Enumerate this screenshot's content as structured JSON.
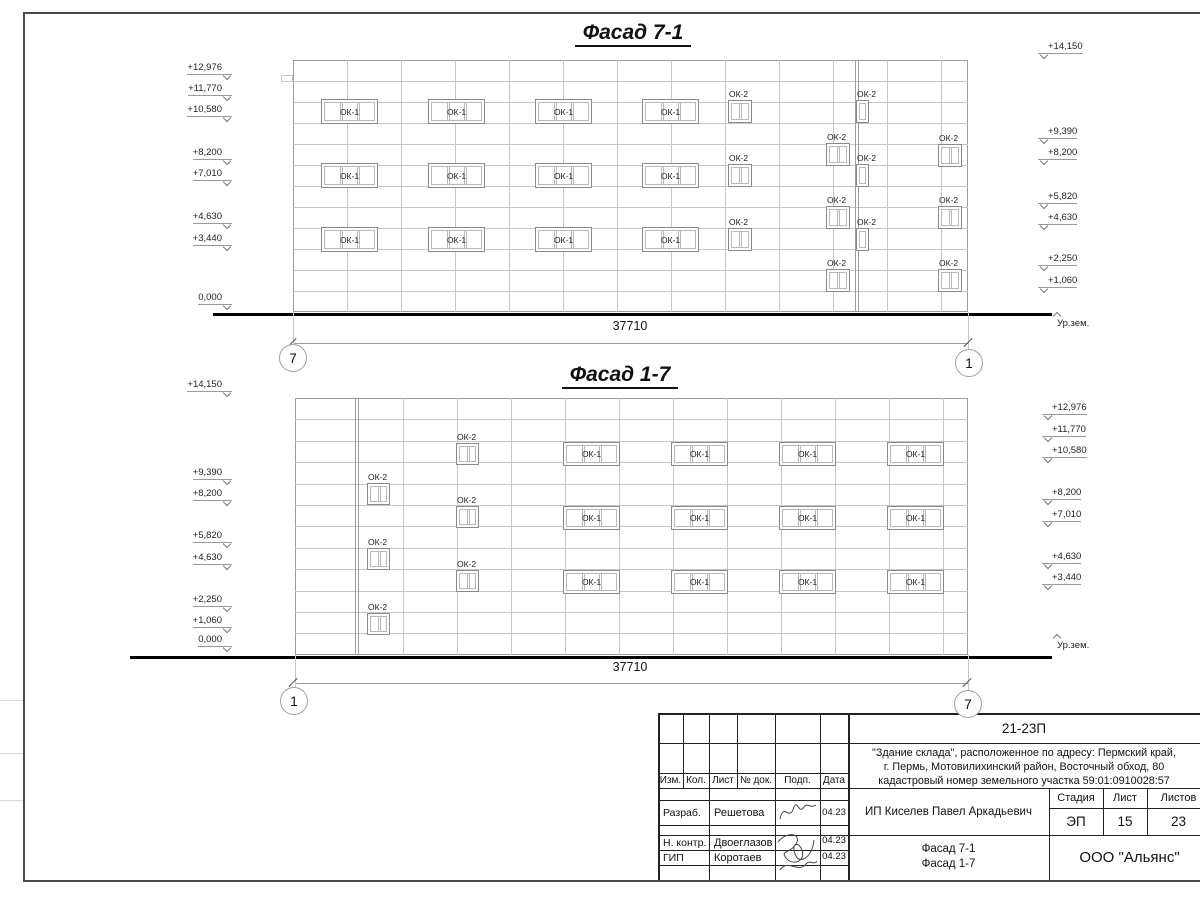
{
  "facades": [
    {
      "title": "Фасад 7-1",
      "box": {
        "x": 293,
        "y": 60,
        "w": 675,
        "h": 252,
        "hlines": 11,
        "hstep": 21,
        "vstep": 54
      },
      "heavy_verticals": [
        855
      ],
      "ledge": {
        "x": 281,
        "y": 75,
        "w": 12,
        "h": 7
      },
      "windows_ok1": {
        "w": 57,
        "h": 25,
        "panes": 3,
        "label": "ОК-1",
        "cols": [
          321,
          428,
          535,
          642
        ],
        "rows": [
          99,
          163,
          227
        ]
      },
      "windows_ok2": {
        "w": 24,
        "h": 23,
        "panes": 2,
        "label": "ОК-2",
        "items": [
          [
            728,
            100
          ],
          [
            728,
            164
          ],
          [
            728,
            228
          ],
          [
            826,
            143
          ],
          [
            826,
            206
          ],
          [
            826,
            269
          ],
          [
            938,
            144
          ],
          [
            938,
            206
          ],
          [
            938,
            269
          ]
        ]
      },
      "windows_ok2_narrow": {
        "w": 13,
        "h": 23,
        "panes": 1,
        "label": "ОК-2",
        "items": [
          [
            856,
            100
          ],
          [
            856,
            164
          ],
          [
            856,
            228
          ]
        ]
      },
      "marks_left": [
        [
          "+12,976",
          68
        ],
        [
          "+11,770",
          89
        ],
        [
          "+10,580",
          110
        ],
        [
          "+8,200",
          153
        ],
        [
          "+7,010",
          174
        ],
        [
          "+4,630",
          217
        ],
        [
          "+3,440",
          239
        ],
        [
          "0,000",
          298
        ]
      ],
      "marks_right": [
        [
          "+14,150",
          47
        ],
        [
          "+9,390",
          132
        ],
        [
          "+8,200",
          153
        ],
        [
          "+5,820",
          197
        ],
        [
          "+4,630",
          218
        ],
        [
          "+2,250",
          259
        ],
        [
          "+1,060",
          281
        ]
      ],
      "marks_left_x": 140,
      "marks_right_x": 1038,
      "ground": {
        "y": 313,
        "x1": 213,
        "x2": 1052,
        "label": "Ур.зем.",
        "lx": 1057,
        "ly": 318
      },
      "dim": {
        "text": "37710",
        "y": 343,
        "tx": 630,
        "ty": 319
      },
      "bubbles": [
        {
          "t": "7",
          "cx": 292,
          "cy": 357
        },
        {
          "t": "1",
          "cx": 968,
          "cy": 362
        }
      ],
      "title_cx": 633,
      "title_cy": 36
    },
    {
      "title": "Фасад 1-7",
      "box": {
        "x": 295,
        "y": 398,
        "w": 673,
        "h": 257,
        "hlines": 11,
        "hstep": 21.4,
        "vstep": 54
      },
      "heavy_verticals": [
        355
      ],
      "ledge": null,
      "windows_ok1": {
        "w": 57,
        "h": 24,
        "panes": 3,
        "label": "ОК-1",
        "cols": [
          563,
          671,
          779,
          887
        ],
        "rows": [
          442,
          506,
          570
        ]
      },
      "windows_ok2": {
        "w": 23,
        "h": 22,
        "panes": 2,
        "label": "ОК-2",
        "items": [
          [
            367,
            483
          ],
          [
            367,
            548
          ],
          [
            367,
            613
          ],
          [
            456,
            443
          ],
          [
            456,
            506
          ],
          [
            456,
            570
          ]
        ]
      },
      "windows_ok2_narrow": {
        "w": 13,
        "h": 22,
        "panes": 1,
        "label": "ОК-2",
        "items": []
      },
      "marks_left": [
        [
          "+14,150",
          385
        ],
        [
          "+9,390",
          473
        ],
        [
          "+8,200",
          494
        ],
        [
          "+5,820",
          536
        ],
        [
          "+4,630",
          558
        ],
        [
          "+2,250",
          600
        ],
        [
          "+1,060",
          621
        ],
        [
          "0,000",
          640
        ]
      ],
      "marks_right": [
        [
          "+12,976",
          408
        ],
        [
          "+11,770",
          430
        ],
        [
          "+10,580",
          451
        ],
        [
          "+8,200",
          493
        ],
        [
          "+7,010",
          515
        ],
        [
          "+4,630",
          557
        ],
        [
          "+3,440",
          578
        ]
      ],
      "marks_left_x": 140,
      "marks_right_x": 1042,
      "ground": {
        "y": 656,
        "x1": 130,
        "x2": 1052,
        "label": "Ур.зем.",
        "lx": 1057,
        "ly": 640
      },
      "dim": {
        "text": "37710",
        "y": 683,
        "tx": 630,
        "ty": 660
      },
      "bubbles": [
        {
          "t": "1",
          "cx": 293,
          "cy": 700
        },
        {
          "t": "7",
          "cx": 967,
          "cy": 703
        }
      ],
      "title_cx": 620,
      "title_cy": 378
    }
  ],
  "titleblock": {
    "doc_code": "21-23П",
    "address_lines": [
      "\"Здание склада\", расположенное по адресу: Пермский край,",
      "г. Пермь, Мотовилихинский район, Восточный обход, 80",
      "кадастровый номер земельного участка 59:01:0910028:57"
    ],
    "header_cols": [
      "Изм.",
      "Кол.",
      "Лист",
      "№ док.",
      "Подп.",
      "Дата"
    ],
    "rows": [
      {
        "role": "Разраб.",
        "name": "Решетова",
        "date": "04.23"
      },
      {
        "role": "Н. контр.",
        "name": "Двоеглазов",
        "date": "04.23"
      },
      {
        "role": "ГИП",
        "name": "Коротаев",
        "date": "04.23"
      }
    ],
    "client": "ИП Киселев Павел Аркадьевич",
    "stage_header": [
      "Стадия",
      "Лист",
      "Листов"
    ],
    "stage_values": [
      "ЭП",
      "15",
      "23"
    ],
    "sheet_title_lines": [
      "Фасад 7-1",
      "Фасад 1-7"
    ],
    "organization": "ООО \"Альянс\""
  },
  "geometry": {
    "tb_lines": [
      [
        658,
        713,
        1210,
        713,
        2
      ],
      [
        658,
        713,
        658,
        881,
        2
      ],
      [
        658,
        880,
        1210,
        880,
        2
      ],
      [
        848,
        713,
        848,
        880,
        2
      ],
      [
        683,
        713,
        683,
        788,
        1
      ],
      [
        709,
        713,
        709,
        880,
        1
      ],
      [
        737,
        713,
        737,
        788,
        1
      ],
      [
        775,
        713,
        775,
        880,
        1
      ],
      [
        820,
        713,
        820,
        880,
        1
      ],
      [
        658,
        743,
        1210,
        743,
        1
      ],
      [
        658,
        773,
        848,
        773,
        1
      ],
      [
        658,
        788,
        1210,
        788,
        1
      ],
      [
        658,
        800,
        848,
        800,
        1
      ],
      [
        658,
        825,
        848,
        825,
        1
      ],
      [
        658,
        835,
        1210,
        835,
        1
      ],
      [
        658,
        850,
        848,
        850,
        1
      ],
      [
        658,
        865,
        848,
        865,
        1
      ],
      [
        1049,
        788,
        1049,
        880,
        1
      ],
      [
        1103,
        788,
        1103,
        835,
        1
      ],
      [
        1147,
        788,
        1147,
        835,
        1
      ],
      [
        1049,
        808,
        1210,
        808,
        1
      ]
    ],
    "frame_lines": [
      [
        23,
        12,
        1210,
        12,
        2
      ],
      [
        23,
        12,
        23,
        881,
        2
      ],
      [
        23,
        880,
        1210,
        880,
        2
      ]
    ],
    "margin_lines": [
      [
        0,
        700,
        23,
        700,
        1
      ],
      [
        0,
        753,
        23,
        753,
        1
      ],
      [
        0,
        800,
        23,
        800,
        1
      ]
    ]
  },
  "colors": {
    "light": "#c6c6c6",
    "mid": "#9b9b9b",
    "dark": "#222222",
    "frame": "#4a4a4a",
    "margin": "#d9d9d9"
  }
}
